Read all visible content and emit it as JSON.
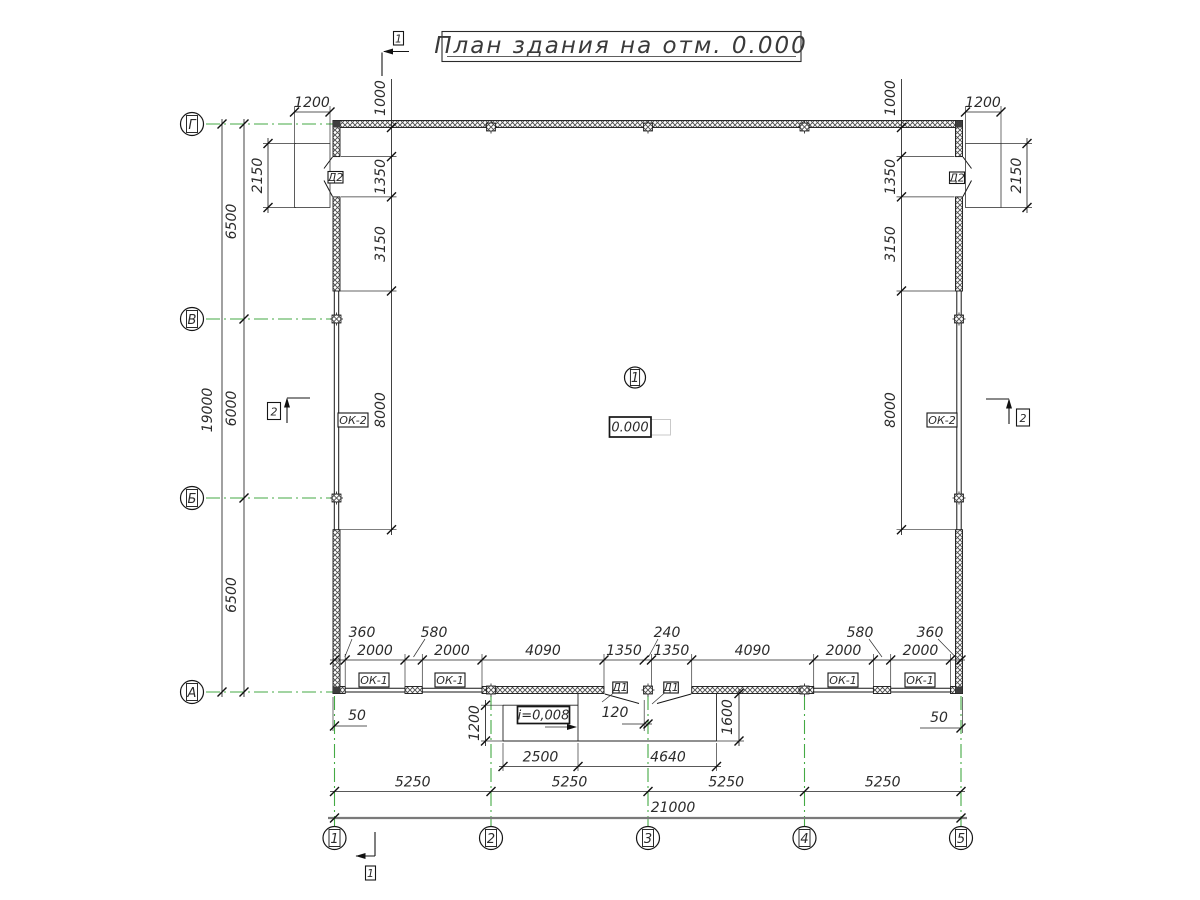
{
  "title": "План здания на отм. 0.000",
  "colors": {
    "axis": "#44aa44",
    "line": "#222222"
  },
  "axes": {
    "columns": [
      "1",
      "2",
      "3",
      "4",
      "5"
    ],
    "rows": [
      "Г",
      "В",
      "Б",
      "А"
    ]
  },
  "dims": {
    "left_total": "19000",
    "left_bays": [
      "6500",
      "6000",
      "6500"
    ],
    "left_chain": [
      "1000",
      "1350",
      "3150",
      "8000"
    ],
    "right_chain": [
      "1000",
      "1350",
      "3150",
      "8000"
    ],
    "porch_left": {
      "width": "1200",
      "depth": "2150"
    },
    "porch_right": {
      "width": "1200",
      "depth": "2150"
    },
    "bottom_chain": [
      "2000",
      "2000",
      "4090",
      "1350",
      "1350",
      "4090",
      "2000",
      "2000"
    ],
    "bottom_small": [
      "360",
      "580",
      "240",
      "580",
      "360"
    ],
    "bottom_bays": [
      "5250",
      "5250",
      "5250",
      "5250"
    ],
    "bottom_total": "21000",
    "offset_left": "50",
    "offset_right": "50",
    "door_axis_offset": "120",
    "ramp_width": "1200",
    "ramp_length": "2500",
    "slope": "i=0,008",
    "porch_depth": "1600",
    "porch_length": "4640"
  },
  "labels": {
    "window_small": "ОК-1",
    "window_large": "ОК-2",
    "door_main": "Д1",
    "door_side": "Д2",
    "elevation": "0.000",
    "room_number": "1",
    "section_1": "1",
    "section_2": "2"
  }
}
